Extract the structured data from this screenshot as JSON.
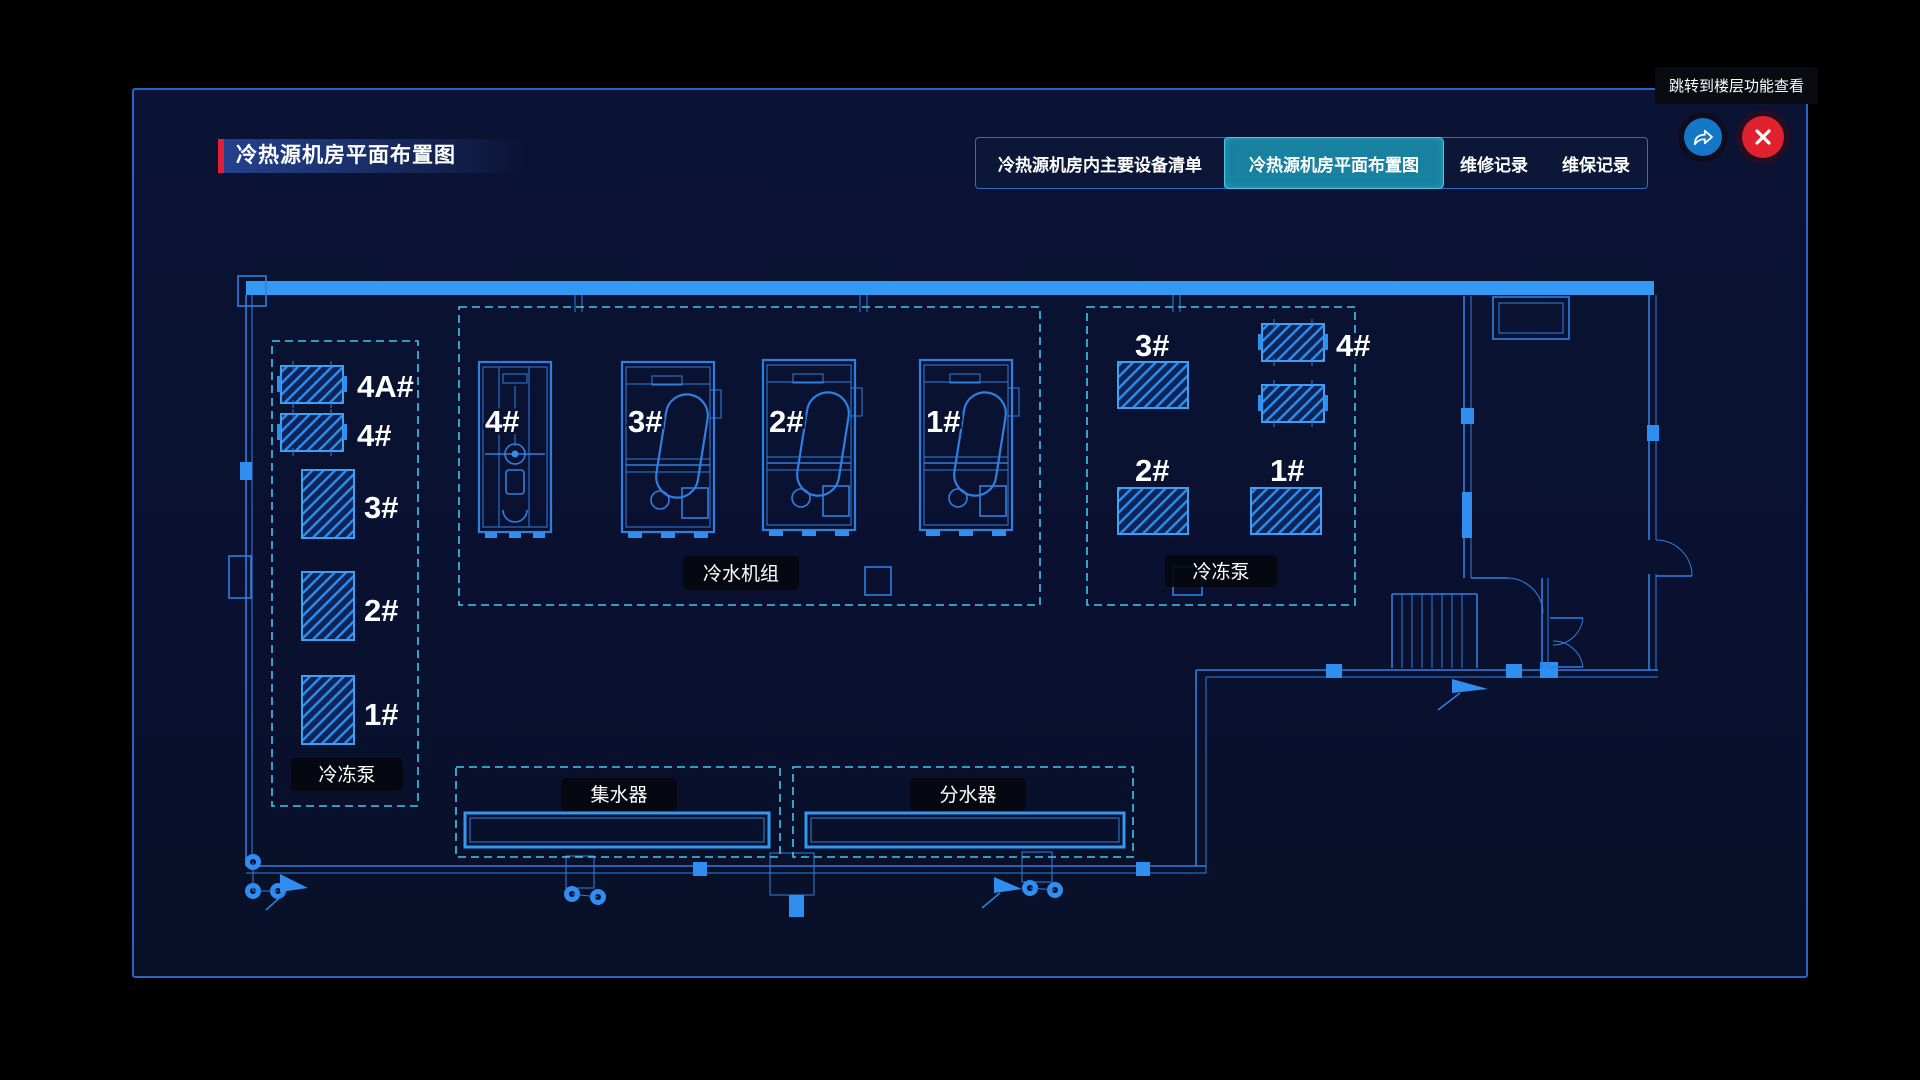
{
  "header": {
    "title": "冷热源机房平面布置图",
    "tooltip": "跳转到楼层功能查看",
    "tabs": [
      {
        "label": "冷热源机房内主要设备清单",
        "active": false
      },
      {
        "label": "冷热源机房平面布置图",
        "active": true
      },
      {
        "label": "维修记录",
        "active": false
      },
      {
        "label": "维保记录",
        "active": false
      }
    ],
    "icons": {
      "jump": "share-arrow-icon",
      "close": "close-x-icon"
    }
  },
  "floorplan": {
    "left_pumps": {
      "group_label": "冷冻泵",
      "units": [
        "4A#",
        "4#",
        "3#",
        "2#",
        "1#"
      ]
    },
    "chillers": {
      "group_label": "冷水机组",
      "units": [
        "4#",
        "3#",
        "2#",
        "1#"
      ]
    },
    "right_pumps": {
      "group_label": "冷冻泵",
      "units": [
        "3#",
        "4#",
        "2#",
        "1#"
      ]
    },
    "collector_label": "集水器",
    "distributor_label": "分水器"
  },
  "colors": {
    "background": "#000000",
    "panel_bg": "#0a1130",
    "panel_border": "#2d63c8",
    "accent_red": "#e31e38",
    "blueprint_line": "#2f7fe0",
    "blueprint_bright": "#3399f2",
    "dashed_outline": "#41c7ee",
    "active_tab_bg": "#17819f",
    "active_tab_border": "#4fc8e8",
    "jump_button": "#1477c8",
    "close_button": "#e2212f"
  }
}
